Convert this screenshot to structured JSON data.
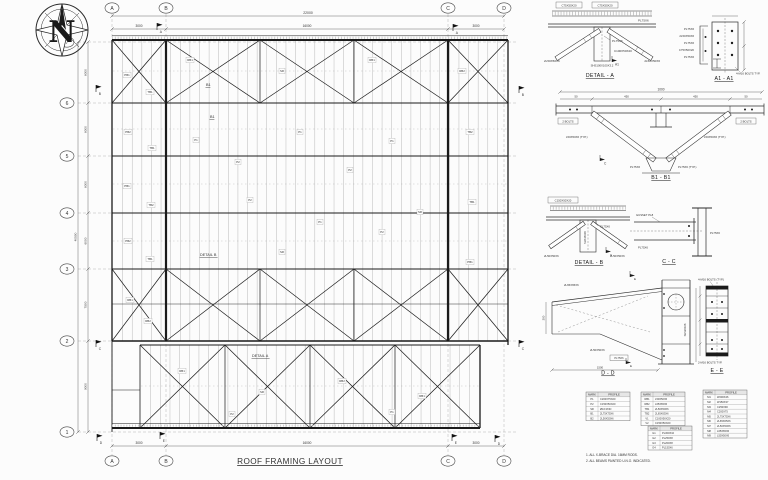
{
  "sheet": {
    "title": "ROOF FRAMING LAYOUT",
    "compass_label": "N"
  },
  "plan": {
    "cols": [
      {
        "name": "A",
        "x": 112
      },
      {
        "name": "B",
        "x": 166
      },
      {
        "name": "C",
        "x": 448
      },
      {
        "name": "D",
        "x": 504
      }
    ],
    "rows": [
      {
        "name": "7",
        "y": 42
      },
      {
        "name": "6",
        "y": 103
      },
      {
        "name": "5",
        "y": 156
      },
      {
        "name": "4",
        "y": 213
      },
      {
        "name": "3",
        "y": 269
      },
      {
        "name": "2",
        "y": 341
      },
      {
        "name": "1",
        "y": 432
      }
    ],
    "dims": {
      "top_overall": "22000",
      "top_segments": [
        "3000",
        "16000",
        "3000"
      ],
      "bottom_segments": [
        "3000",
        "16000",
        "3000"
      ],
      "left_segments": [
        "6000",
        "6000",
        "6000",
        "6000",
        "7500",
        "9000"
      ],
      "left_overall": "40500"
    },
    "labels": [
      {
        "t": "B1",
        "x": 206,
        "y": 86,
        "u": 1
      },
      {
        "t": "B1",
        "x": 210,
        "y": 118,
        "u": 1
      },
      {
        "t": "DETAIL B",
        "x": 200,
        "y": 256,
        "u": 1
      },
      {
        "t": "DETAIL A",
        "x": 252,
        "y": 357,
        "u": 1
      }
    ],
    "flags": [
      [
        157,
        30,
        "A"
      ],
      [
        453,
        31,
        "A"
      ],
      [
        96,
        92,
        "B"
      ],
      [
        519,
        93,
        "B"
      ],
      [
        96,
        347,
        "C"
      ],
      [
        519,
        347,
        "C"
      ],
      [
        97,
        441,
        "D"
      ],
      [
        495,
        442,
        "D"
      ],
      [
        160,
        439,
        "E"
      ],
      [
        452,
        441,
        "E"
      ]
    ],
    "tags": [
      [
        127,
        75,
        "PB1"
      ],
      [
        150,
        92,
        "TB1"
      ],
      [
        128,
        132,
        "PB2"
      ],
      [
        152,
        148,
        "TB1"
      ],
      [
        127,
        186,
        "PB1"
      ],
      [
        151,
        205,
        "TB2"
      ],
      [
        128,
        241,
        "PB2"
      ],
      [
        150,
        259,
        "TB1"
      ],
      [
        130,
        300,
        "RB1"
      ],
      [
        148,
        321,
        "RB2"
      ],
      [
        196,
        140,
        "P1"
      ],
      [
        238,
        162,
        "P2"
      ],
      [
        300,
        132,
        "P1"
      ],
      [
        350,
        170,
        "P2"
      ],
      [
        392,
        141,
        "P1"
      ],
      [
        250,
        200,
        "P2"
      ],
      [
        320,
        222,
        "P1"
      ],
      [
        382,
        232,
        "P2"
      ],
      [
        282,
        252,
        "SR"
      ],
      [
        420,
        212,
        "SR"
      ],
      [
        190,
        60,
        "RB1"
      ],
      [
        282,
        71,
        "SR"
      ],
      [
        372,
        60,
        "RB1"
      ],
      [
        462,
        71,
        "RB2"
      ],
      [
        470,
        132,
        "TB2"
      ],
      [
        472,
        202,
        "TB1"
      ],
      [
        470,
        262,
        "PB1"
      ],
      [
        182,
        371,
        "RB1"
      ],
      [
        262,
        392,
        "SR"
      ],
      [
        342,
        381,
        "RB2"
      ],
      [
        422,
        396,
        "RB1"
      ],
      [
        232,
        414,
        "P2"
      ],
      [
        392,
        412,
        "P1"
      ]
    ],
    "purlins": [
      {
        "x1": 113,
        "x2": 507,
        "y1": 40,
        "y2": 341,
        "n": 41
      },
      {
        "x1": 141,
        "x2": 479,
        "y1": 345,
        "y2": 428,
        "n": 35
      }
    ],
    "bridging": [
      {
        "x1": 113,
        "x2": 507,
        "y": 71
      },
      {
        "x1": 113,
        "x2": 507,
        "y": 129
      },
      {
        "x1": 113,
        "x2": 507,
        "y": 184
      },
      {
        "x1": 113,
        "x2": 507,
        "y": 241
      },
      {
        "x1": 141,
        "x2": 479,
        "y": 386
      }
    ],
    "xbands": [
      {
        "y1": 40,
        "y2": 103,
        "xs": [
          112,
          166,
          260,
          354,
          448,
          508
        ]
      },
      {
        "y1": 269,
        "y2": 341,
        "xs": [
          112,
          166,
          260,
          354,
          448,
          508
        ]
      },
      {
        "y1": 345,
        "y2": 428,
        "xs": [
          140,
          225,
          310,
          395,
          480
        ]
      }
    ]
  },
  "details": {
    "a": {
      "caption": "DETAIL - A",
      "sec": "A1",
      "labels": [
        "C75X50X20",
        "C75X50X20",
        "PL75X6",
        "2L50X50X6",
        "2L50X50X6",
        "PL75X6",
        "C100X50X20",
        "SHS100X100X3.2"
      ]
    },
    "a1": {
      "caption": "A1 - A1",
      "note": "4-M16 BOLTS TYP.",
      "labels": [
        "PL75X6",
        "2L50X50X6",
        "PL75X6",
        "C75X50X20",
        "PL75X6"
      ]
    },
    "b1": {
      "caption": "B1 - B1",
      "overall": "1000",
      "segs": [
        "50",
        "450",
        "450",
        "50"
      ],
      "sec": "C",
      "labels": [
        "2 BOLTS",
        "L50X50X6 (TYP.)",
        "2 BOLTS",
        "L50X50X6 (TYP.)",
        "PL75X6",
        "PL75X6 (TYP.)"
      ]
    },
    "b": {
      "caption": "DETAIL - B",
      "sec": "C",
      "labels": [
        "C150X50X20",
        "2L50X50X6",
        "2L50X50X6",
        "PL75X6",
        "SHS150X6"
      ]
    },
    "cc": {
      "caption": "C - C",
      "labels": [
        "GUSSET PL8",
        "PL75X6",
        "PL75X6"
      ]
    },
    "dd": {
      "caption": "D - D",
      "sec": "E",
      "dim_w": "1500",
      "dim_h": "300",
      "labels": [
        "2L65X65X6",
        "2L50X50X6",
        "PL75X6",
        "SHS200X6"
      ]
    },
    "ee": {
      "caption": "E - E",
      "top_note": "4-M16 BOLTS (TYP.)",
      "bottom_note": "2-M16 BOLTS TYP."
    },
    "tables": [
      {
        "headers": [
          "MARK",
          "PROFILE"
        ],
        "rows": [
          [
            "P1",
            "C200X75X20"
          ],
          [
            "P2",
            "C150X50X20"
          ],
          [
            "SR",
            "Ø16 ROD"
          ],
          [
            "B1",
            "2L75X75X6"
          ],
          [
            "B2",
            "2L50X50X6"
          ]
        ]
      },
      {
        "headers": [
          "MARK",
          "PROFILE"
        ],
        "rows": [
          [
            "RB1",
            "L50X50X6"
          ],
          [
            "RB2",
            "L65X65X6"
          ],
          [
            "TB1",
            "2L50X50X6"
          ],
          [
            "TB2",
            "2L65X65X6"
          ],
          [
            "V1",
            "C100X50X20"
          ],
          [
            "V2",
            "C150X50X20"
          ]
        ]
      },
      {
        "headers": [
          "MARK",
          "PROFILE"
        ],
        "rows": [
          [
            "G1",
            "PL300X10"
          ],
          [
            "G2",
            "PL250X8"
          ],
          [
            "G3",
            "PL200X8"
          ],
          [
            "G4",
            "PL150X6"
          ]
        ]
      },
      {
        "headers": [
          "MARK",
          "PROFILE"
        ],
        "rows": [
          [
            "M1",
            "W200X46"
          ],
          [
            "M2",
            "W150X37"
          ],
          [
            "M3",
            "C250X90"
          ],
          [
            "M4",
            "C200X75"
          ],
          [
            "M5",
            "2L75X75X6"
          ],
          [
            "M6",
            "2L65X65X6"
          ],
          [
            "M7",
            "2L50X50X6"
          ],
          [
            "M8",
            "L65X65X6"
          ],
          [
            "M9",
            "L50X50X6"
          ]
        ]
      }
    ]
  },
  "notes": [
    "1. ALL X-BRACE DIA. 16MM RODS.",
    "2. ALL BEAMS PAINTED U.N.O. INDICATED."
  ]
}
